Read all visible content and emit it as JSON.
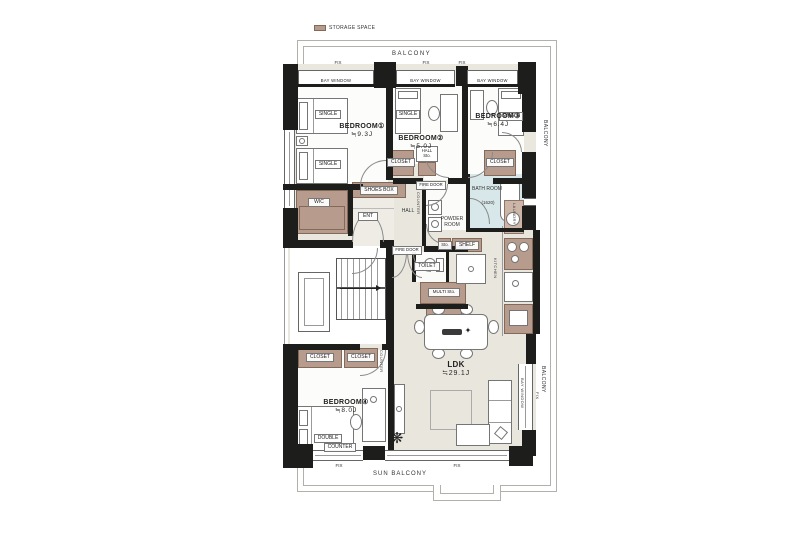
{
  "legend": {
    "label": "STORAGE SPACE"
  },
  "balcony": {
    "top": "BALCONY",
    "right_top": "BALCONY",
    "right_bottom": "BALCONY",
    "sun": "SUN BALCONY"
  },
  "win": {
    "bay": "BAY WINDOW",
    "fix": "FIX"
  },
  "rooms": {
    "bedroom1": {
      "name": "BEDROOM①",
      "size": "≒9.3J"
    },
    "bedroom2": {
      "name": "BEDROOM②",
      "size": "≒5.0J"
    },
    "bedroom3": {
      "name": "BEDROOM③",
      "size": "≒6.4J"
    },
    "bedroom4": {
      "name": "BEDROOM④",
      "size": "≒8.0J"
    },
    "ldk": {
      "name": "LDK",
      "size": "≒29.1J"
    },
    "bath": {
      "name": "BATH ROOM",
      "size": "(1620)"
    },
    "powder": {
      "name": "POWDER ROOM"
    },
    "toilet": {
      "name": "TOILET"
    },
    "hall": {
      "name": "HALL"
    },
    "ent": {
      "name": "ENT"
    },
    "wic": {
      "name": "WIC"
    }
  },
  "fixtures": {
    "shoes_box": "SHOES BOX",
    "hall_sto": "HALL Sto.",
    "closet": "CLOSET",
    "shelf": "SHELF",
    "sto": "Sto.",
    "multi_sto": "MULTI Sto.",
    "fire_door": "FIRE DOOR",
    "counter": "COUNTER",
    "laundry": "LAUNDRY",
    "kitchen": "KITCHEN",
    "single": "SINGLE",
    "double": "DOUBLE"
  },
  "icons": {
    "plant": "❋",
    "table_star": "✦"
  },
  "colors": {
    "wall": "#1d1d1b",
    "storage": "#b79c8d",
    "bath": "#d8e7e9",
    "floor": "#eae7df"
  }
}
